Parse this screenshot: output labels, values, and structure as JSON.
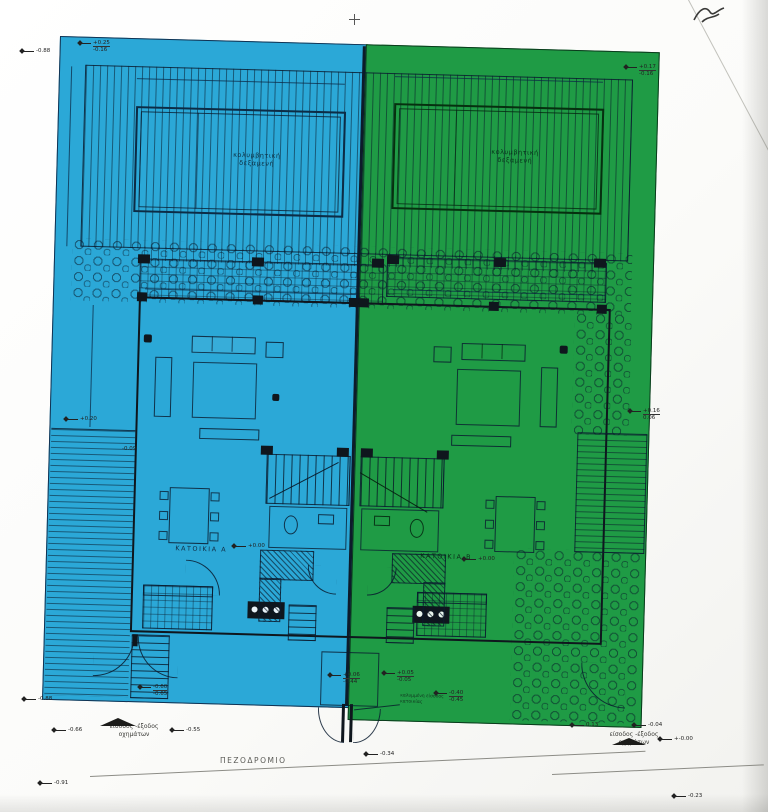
{
  "labels": {
    "sidewalk": "ΠΕΖΟΔΡΟΜΙΟ",
    "vehicle_entry_line1": "είσοδος -έξοδος",
    "vehicle_entry_line2": "οχημάτων",
    "unit_a": "ΚΑΤΟΙΚΙΑ Α",
    "unit_b": "ΚΑΤΟΙΚΙΑ Β",
    "pool_line1": "κολυμβητική",
    "pool_line2": "δεξαμενή",
    "entry_note": "καλυμμένη είσοδος κατοικίας"
  },
  "markers": {
    "outer_top_left": "-0.88",
    "corner_a_top": "+0.25",
    "corner_a_bottom": "-0.16",
    "corner_b_top": "+0.17",
    "corner_b_bottom": "-0.16",
    "left_terrace": "+0.20",
    "left_dim": "-0.09",
    "right_terrace_top": "+0.16",
    "right_terrace_bottom": "0.06",
    "unit_a_level": "+0.00",
    "unit_b_level": "+0.00",
    "outer_bottom_left": "-0.88",
    "gate_a_top": "-0.60",
    "gate_a_bottom": "-0.65",
    "gate_b_top": "-0.40",
    "gate_b_bottom": "-0.45",
    "street_a": "-0.66",
    "street_b": "-0.55",
    "porch_a_top": "+0.06",
    "porch_a_bottom": "-0.44",
    "porch_b_top": "+0.05",
    "porch_b_bottom": "-0.05",
    "center_gate": "-0.34",
    "street_c": "0.13",
    "street_zero": "+-0.00",
    "road_left": "-0.91",
    "road_right": "-0.23",
    "garden_b": "-0.04"
  },
  "colors": {
    "unit_a_fill": "#2ba8d7",
    "unit_b_fill": "#1f9b45",
    "linework": "#123252",
    "walls": "#0f161d"
  }
}
